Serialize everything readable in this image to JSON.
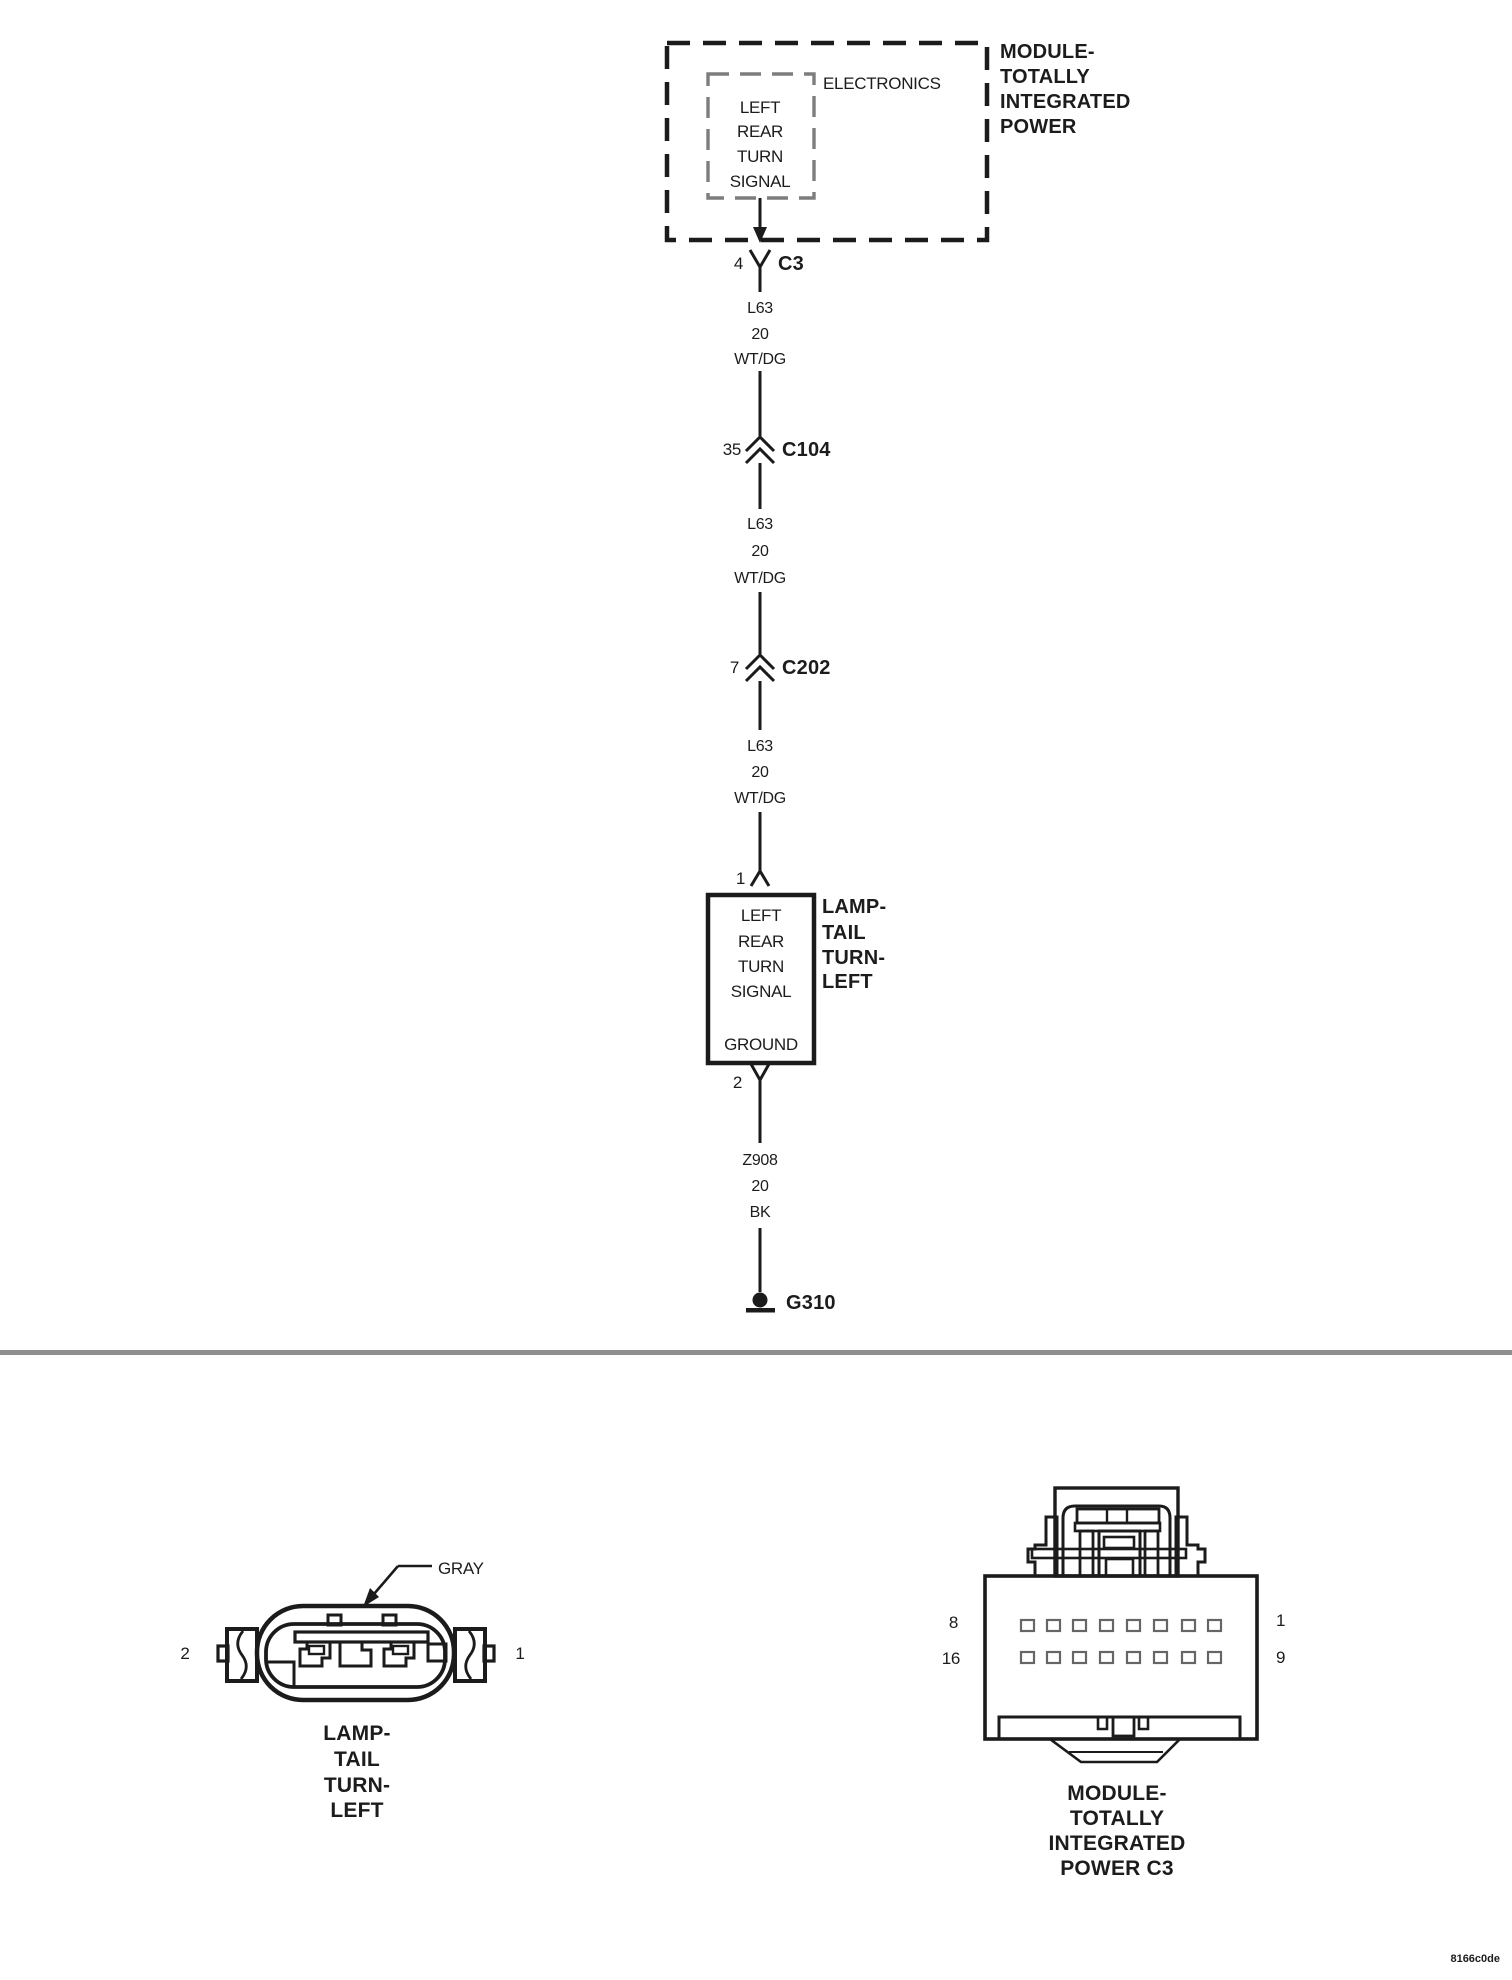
{
  "schematic": {
    "module": {
      "name_lines": [
        "MODULE-",
        "TOTALLY",
        "INTEGRATED",
        "POWER"
      ],
      "electronics_label": "ELECTRONICS",
      "component_lines": [
        "LEFT",
        "REAR",
        "TURN",
        "SIGNAL"
      ]
    },
    "c3": {
      "pin": "4",
      "name": "C3"
    },
    "wire1": {
      "circuit": "L63",
      "gauge": "20",
      "color": "WT/DG"
    },
    "c104": {
      "pin": "35",
      "name": "C104"
    },
    "wire2": {
      "circuit": "L63",
      "gauge": "20",
      "color": "WT/DG"
    },
    "c202": {
      "pin": "7",
      "name": "C202"
    },
    "wire3": {
      "circuit": "L63",
      "gauge": "20",
      "color": "WT/DG"
    },
    "lamp": {
      "pin_in": "1",
      "pin_out": "2",
      "component_lines": [
        "LEFT",
        "REAR",
        "TURN",
        "SIGNAL"
      ],
      "ground_terminal": "GROUND",
      "name_lines": [
        "LAMP-",
        "TAIL",
        "TURN-",
        "LEFT"
      ]
    },
    "wire4": {
      "circuit": "Z908",
      "gauge": "20",
      "color": "BK"
    },
    "ground": {
      "name": "G310"
    }
  },
  "inset_left": {
    "color_callout": "GRAY",
    "pin_left": "2",
    "pin_right": "1",
    "caption_lines": [
      "LAMP-",
      "TAIL",
      "TURN-",
      "LEFT"
    ]
  },
  "inset_right": {
    "pin_row1_left": "8",
    "pin_row2_left": "16",
    "pin_row1_right": "1",
    "pin_row2_right": "9",
    "caption_lines": [
      "MODULE-",
      "TOTALLY",
      "INTEGRATED",
      "POWER C3"
    ]
  },
  "footer": {
    "code": "8166c0de"
  },
  "colors": {
    "line": "#1b1b1b",
    "inner_dash": "#7d7d7d",
    "divider": "#8f8f8f",
    "terminal": "#666666"
  }
}
